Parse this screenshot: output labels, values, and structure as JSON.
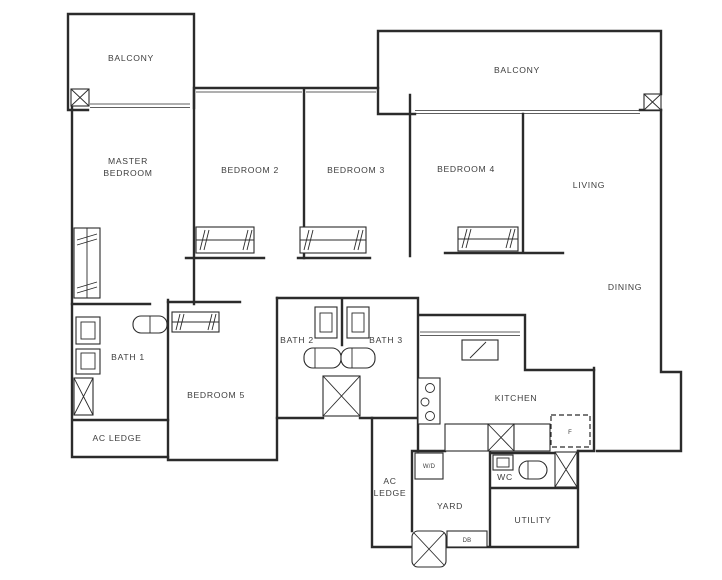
{
  "document": {
    "type": "apartment-floor-plan"
  },
  "colors": {
    "wall": "#2b2b2b",
    "text": "#3d3d3d",
    "background": "#ffffff"
  },
  "labels": {
    "balcony_left": "BALCONY",
    "balcony_right": "BALCONY",
    "master_bedroom": {
      "line1": "MASTER",
      "line2": "BEDROOM"
    },
    "bedroom_2": "BEDROOM 2",
    "bedroom_3": "BEDROOM 3",
    "bedroom_4": "BEDROOM 4",
    "bedroom_5": "BEDROOM 5",
    "living": "LIVING",
    "dining": "DINING",
    "bath_1": "BATH 1",
    "bath_2": "BATH 2",
    "bath_3": "BATH 3",
    "ac_ledge_left": "AC LEDGE",
    "ac_ledge_bottom": {
      "line1": "AC",
      "line2": "LEDGE"
    },
    "kitchen": "KITCHEN",
    "yard": "YARD",
    "wc": "WC",
    "utility": "UTILITY",
    "washer_dryer": "W/D",
    "distribution_board": "DB",
    "fridge": "F"
  }
}
